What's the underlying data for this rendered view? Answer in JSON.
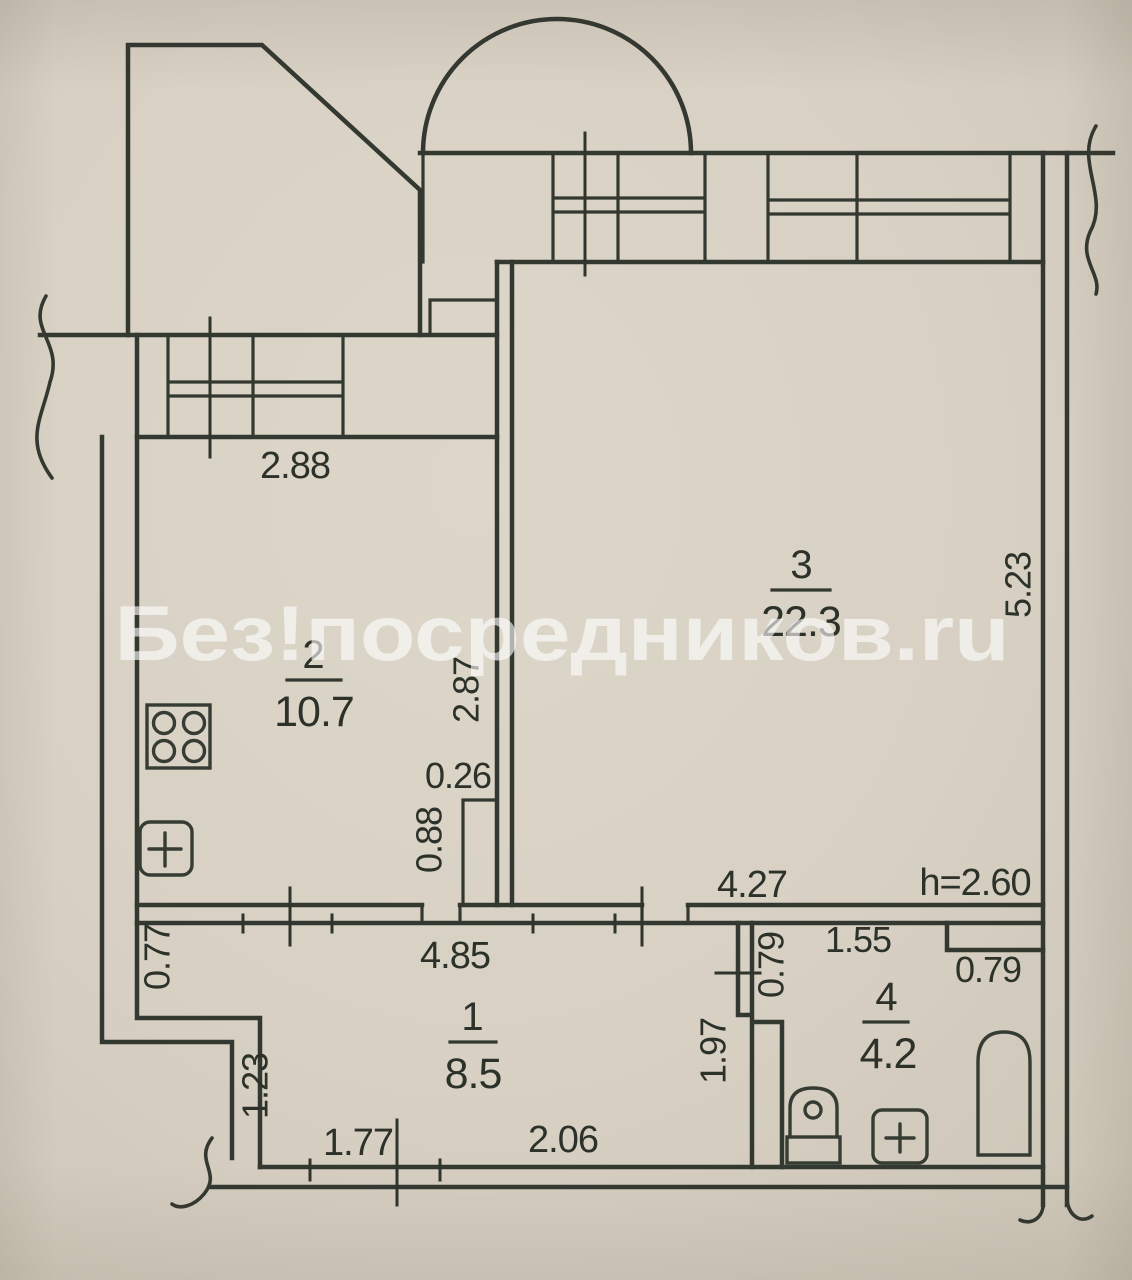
{
  "watermark": "Без!посредников.ru",
  "note_height": "h=2.60",
  "rooms": {
    "r1": {
      "number": "1",
      "area": "8.5"
    },
    "r2": {
      "number": "2",
      "area": "10.7"
    },
    "r3": {
      "number": "3",
      "area": "22.3"
    },
    "r4": {
      "number": "4",
      "area": "4.2"
    }
  },
  "dims": {
    "kitchen_width": "2.88",
    "kitchen_wall": "2.87",
    "shaft_width": "0.26",
    "shaft_height": "0.88",
    "hall_top": "4.85",
    "room3_bottom": "4.27",
    "room3_right": "5.23",
    "left_nook": "0.77",
    "left_step": "1.23",
    "hall_bottom_left": "1.77",
    "hall_bottom_right": "2.06",
    "hall_right": "1.97",
    "bath_partition": "0.79",
    "bath_top": "1.55",
    "bath_niche": "0.79"
  },
  "colors": {
    "paper": "#d8d1c4",
    "ink": "#333830",
    "watermark": "#ffffff"
  }
}
